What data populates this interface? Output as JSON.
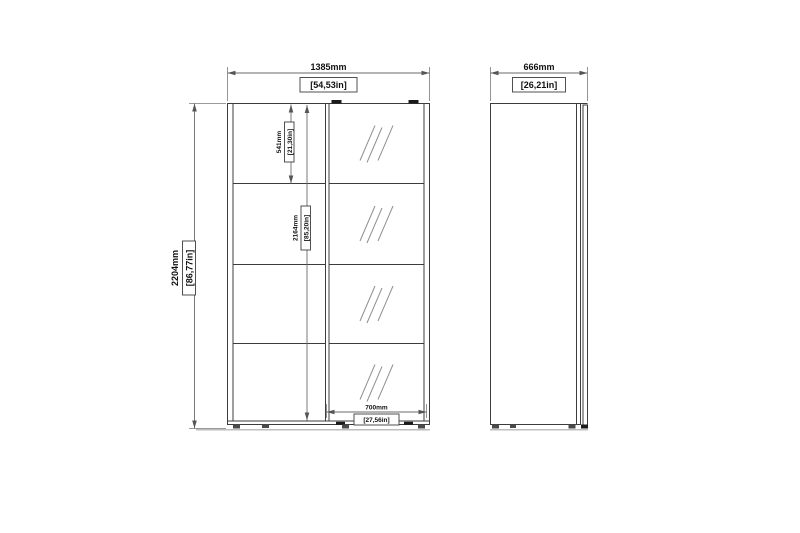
{
  "drawing": {
    "front_view": {
      "width": {
        "mm": "1385mm",
        "inch": "[54,53in]"
      },
      "height": {
        "mm": "2204mm",
        "inch": "[86,77in]"
      },
      "top_section": {
        "mm": "541mm",
        "inch": "[21,30in]"
      },
      "interior_height": {
        "mm": "2164mm",
        "inch": "[85,20in]"
      },
      "mirror_door_width": {
        "mm": "700mm",
        "inch": "[27,56in]"
      }
    },
    "side_view": {
      "depth": {
        "mm": "666mm",
        "inch": "[26,21in]"
      }
    },
    "colors": {
      "background": "#ffffff",
      "structure_line": "#3d3d3d",
      "dimension_line": "#6a6a6a",
      "mirror_hatch": "#8f8f8f",
      "text": "#111111"
    }
  }
}
